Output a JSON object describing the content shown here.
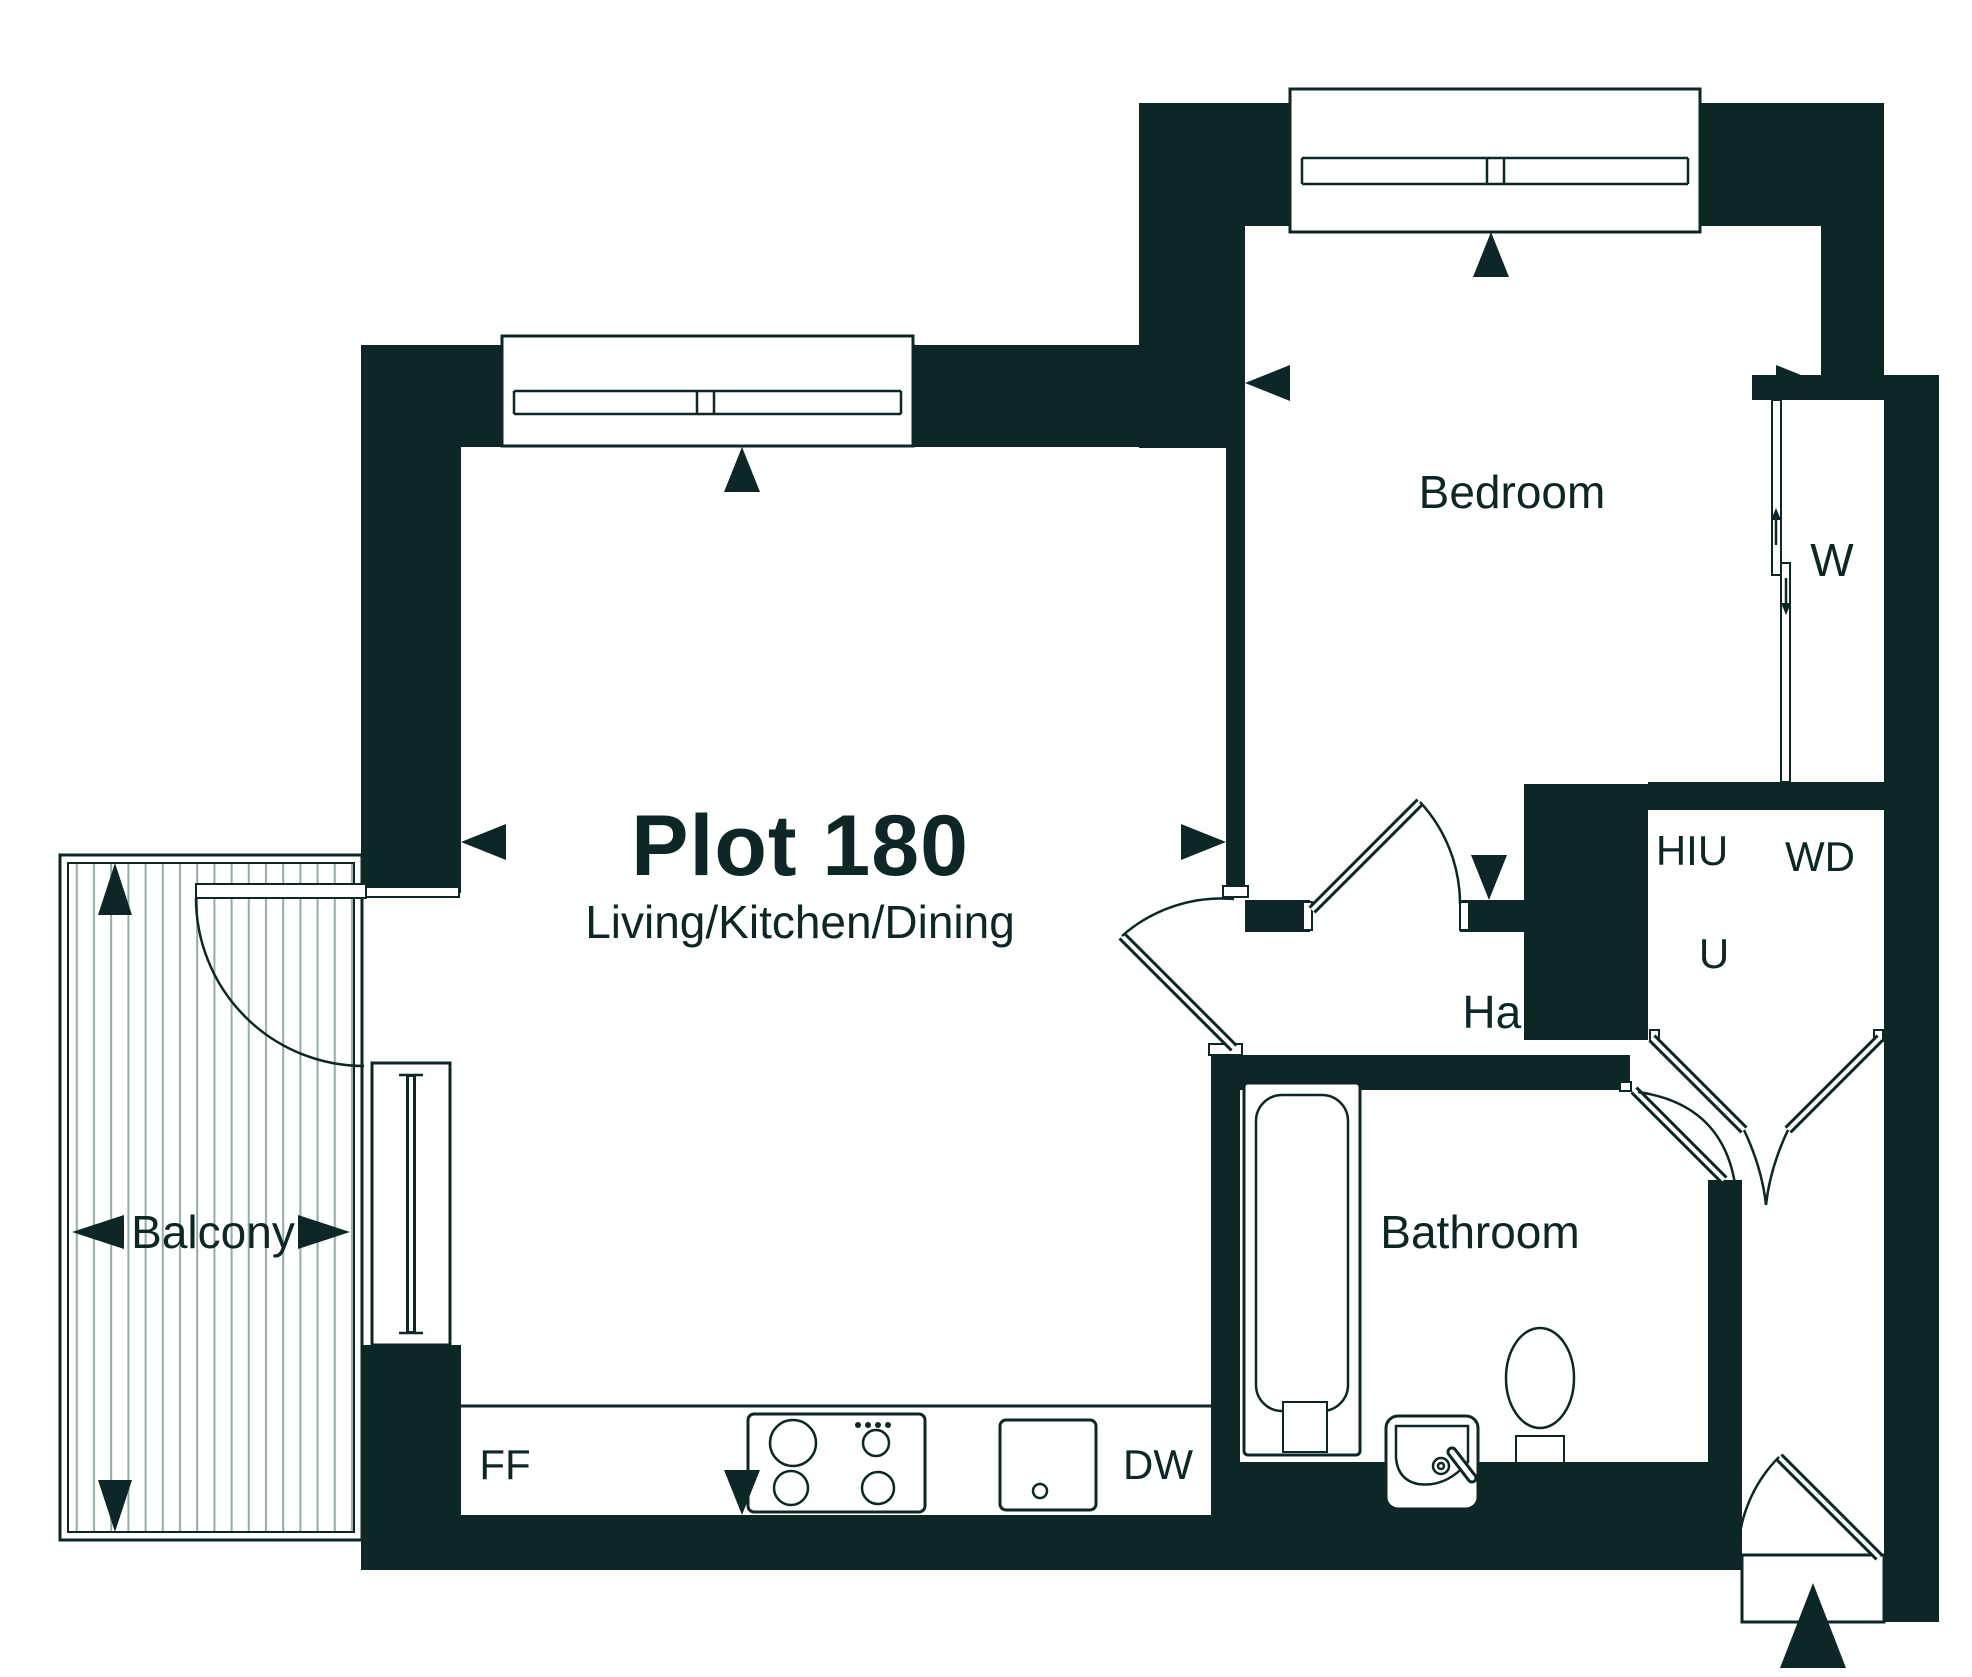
{
  "unit": {
    "title": "Plot 180",
    "subtitle": "Living/Kitchen/Dining"
  },
  "rooms": [
    {
      "name": "Bedroom"
    },
    {
      "name": "Hall"
    },
    {
      "name": "Bathroom"
    },
    {
      "name": "Balcony"
    }
  ],
  "tags": {
    "wardrobe": "W",
    "heat_interface_unit": "HIU",
    "washer_dryer": "WD",
    "utility": "U",
    "fridge_freezer": "FF",
    "dishwasher": "DW"
  },
  "colors": {
    "ink": "#0c2725",
    "background": "#ffffff",
    "decking": "#93aaa6"
  }
}
